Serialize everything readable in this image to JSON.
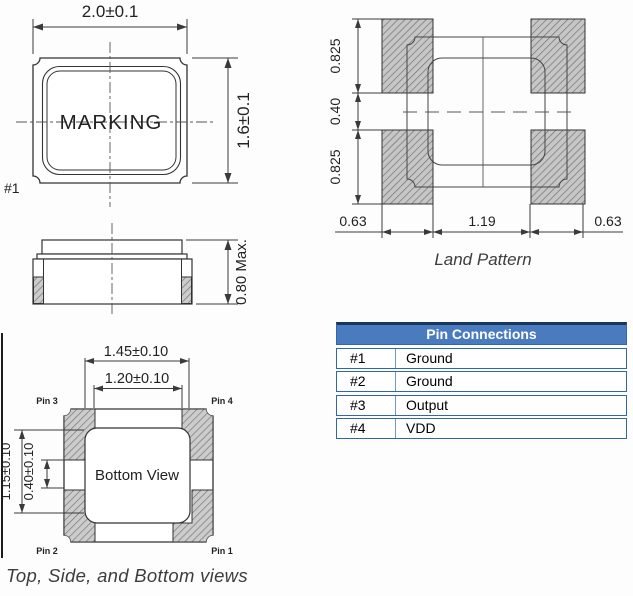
{
  "top_view": {
    "width_dim": "2.0±0.1",
    "height_dim": "1.6±0.1",
    "marking": "MARKING",
    "pin1_ref": "#1"
  },
  "side_view": {
    "height_dim": "0.80 Max."
  },
  "bottom_view": {
    "outer_width_dim": "1.45±0.10",
    "inner_width_dim": "1.20±0.10",
    "outer_height_dim": "1.15±0.10",
    "inner_height_dim": "0.40±0.10",
    "label": "Bottom View",
    "pins": {
      "top_left": "Pin 3",
      "top_right": "Pin 4",
      "bottom_left": "Pin 2",
      "bottom_right": "Pin 1"
    }
  },
  "land_pattern": {
    "caption": "Land Pattern",
    "pad_height_top": "0.825",
    "gap_height": "0.40",
    "pad_height_bottom": "0.825",
    "pad_width_left": "0.63",
    "pad_span": "1.19",
    "pad_width_right": "0.63"
  },
  "views_caption": "Top, Side, and Bottom views",
  "pin_table": {
    "title": "Pin Connections",
    "rows": [
      {
        "pin": "#1",
        "connection": "Ground"
      },
      {
        "pin": "#2",
        "connection": "Ground"
      },
      {
        "pin": "#3",
        "connection": "Output"
      },
      {
        "pin": "#4",
        "connection": "VDD"
      }
    ],
    "colors": {
      "header_bg": "#4b7bbf",
      "header_text": "#ffffff",
      "border_blue": "#2f66ac",
      "top_border": "#17375e",
      "line_color": "#3a3a3a",
      "hatch_fill": "#cccccc"
    }
  }
}
